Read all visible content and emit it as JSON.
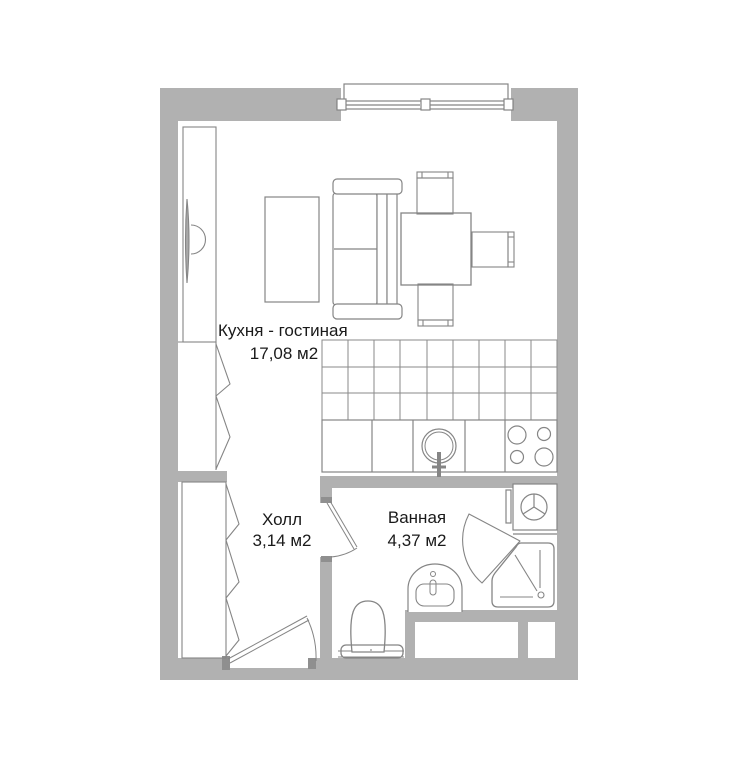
{
  "plan": {
    "rooms": [
      {
        "name": "Кухня - гостиная",
        "area": "17,08 м2"
      },
      {
        "name": "Холл",
        "area": "3,14 м2"
      },
      {
        "name": "Ванная",
        "area": "4,37 м2"
      }
    ],
    "colors": {
      "wall": "#b1b1b1",
      "line": "#858585",
      "text": "#1a1a1a",
      "background": "#ffffff"
    },
    "fixtures": [
      "window",
      "balcony-sill",
      "wall-tv",
      "closet",
      "wardrobe-kitchen",
      "wardrobe-hall",
      "coffee-table",
      "sofa",
      "dining-table",
      "chair-top",
      "chair-bottom",
      "chair-right",
      "kitchen-backsplash-tiles",
      "kitchen-counter",
      "kitchen-sink",
      "stove-4-burners",
      "washing-machine",
      "shower-cabin",
      "bathroom-sink",
      "toilet",
      "entrance-door",
      "bathroom-door",
      "vent-shafts"
    ]
  }
}
